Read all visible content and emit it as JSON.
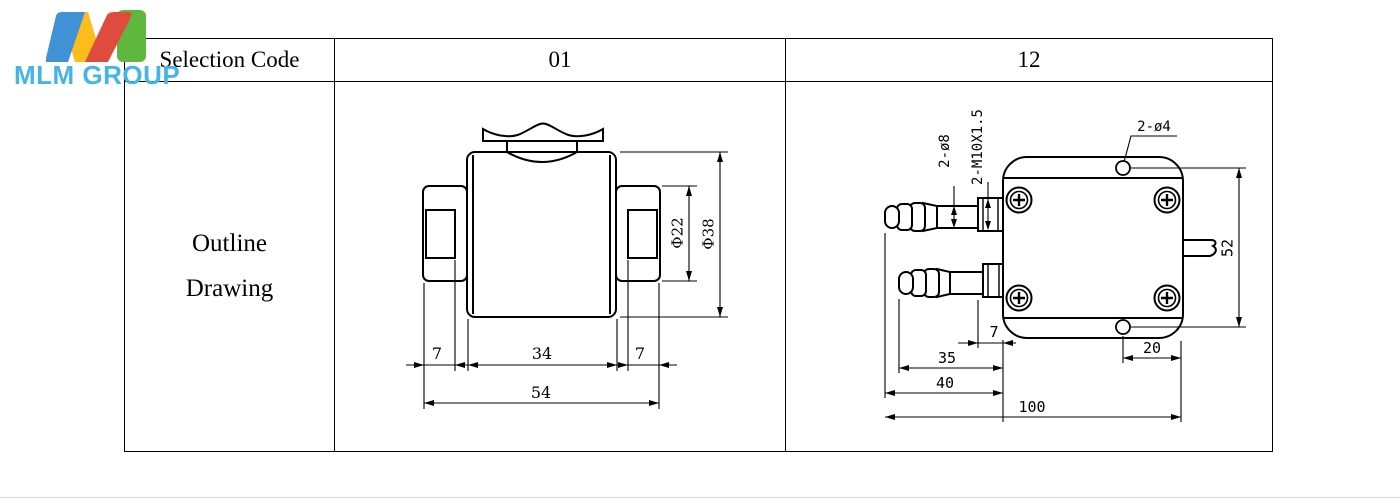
{
  "logo": {
    "text": "MLM GROUP",
    "text_color": "#45b5e8",
    "m_colors": {
      "blue": "#4191d6",
      "yellow": "#fbbc1c",
      "red": "#df4b3d",
      "green": "#5db83d"
    }
  },
  "table": {
    "header": {
      "selection_code": "Selection Code",
      "code_01": "01",
      "code_12": "12"
    },
    "body": {
      "row_label_line1": "Outline",
      "row_label_line2": "Drawing"
    }
  },
  "drawing_01": {
    "dim_phi22": "Φ22",
    "dim_phi38": "Φ38",
    "dim_7_left": "7",
    "dim_34": "34",
    "dim_7_right": "7",
    "dim_54": "54"
  },
  "drawing_12": {
    "label_2_o8": "2-ø8",
    "label_2_m10": "2-M10X1.5",
    "label_2_o4": "2-ø4",
    "dim_52": "52",
    "dim_7": "7",
    "dim_35": "35",
    "dim_40": "40",
    "dim_100": "100",
    "dim_20": "20"
  }
}
